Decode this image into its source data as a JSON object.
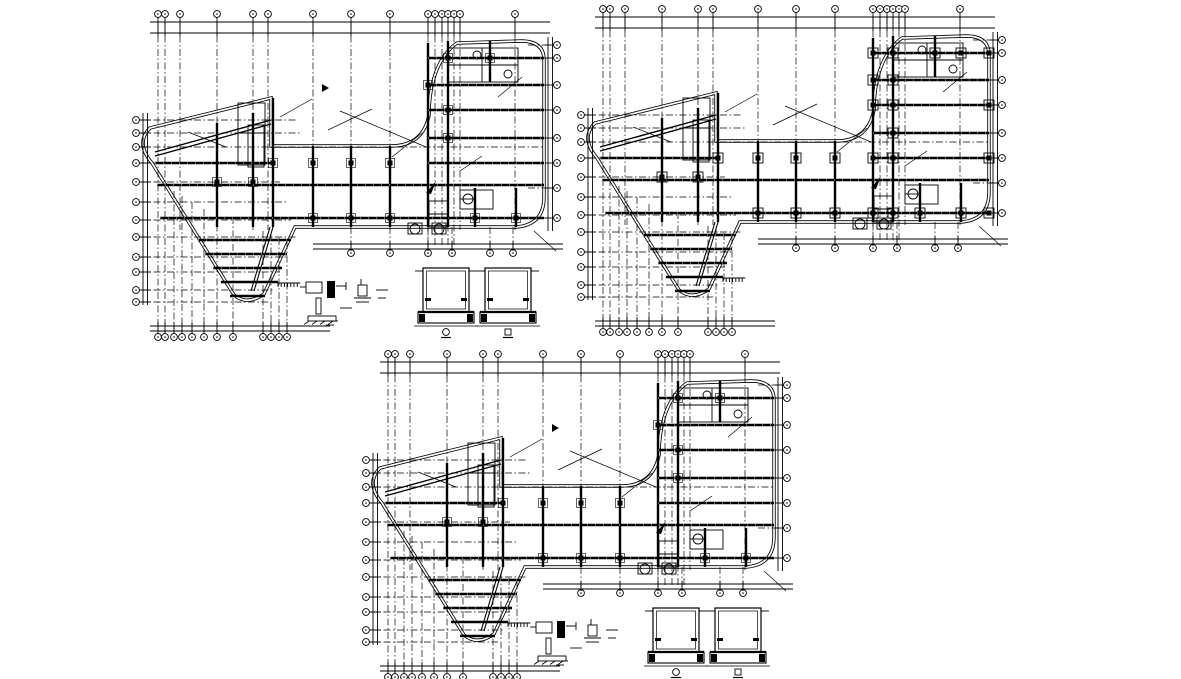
{
  "meta": {
    "document_type": "cad-structural-framing-plans",
    "canvas": {
      "width": 1181,
      "height": 679
    },
    "colors": {
      "background": "#ffffff",
      "line": "#000000"
    }
  },
  "drawing": {
    "plans": [
      {
        "id": "framing-plan-top-left",
        "origin": {
          "x": 130,
          "y": 5
        },
        "variant": "simple",
        "has_details": true,
        "has_cursor": true
      },
      {
        "id": "framing-plan-top-right",
        "origin": {
          "x": 575,
          "y": 0
        },
        "variant": "boxed",
        "has_details": false,
        "has_cursor": false
      },
      {
        "id": "framing-plan-bottom",
        "origin": {
          "x": 360,
          "y": 345
        },
        "variant": "simple",
        "has_details": true,
        "has_cursor": true
      }
    ],
    "template": {
      "outline": "M20,123 L141,93 L141,141 L261,141 Q293,141 299,110 C299,90 303,55 327,38 L391,36 Q414,36 414,55 L414,192 Q414,220 386,222 L165,222 L134,289 Q117,301 104,290 L22,158 Q5,138 20,123 Z",
      "wing_slope": [
        [
          25,
          147,
          141,
          115
        ],
        [
          25,
          151,
          141,
          119
        ]
      ],
      "beams_h": [
        [
          25,
          158,
          143
        ],
        [
          27,
          180,
          414
        ],
        [
          30,
          213,
          414
        ],
        [
          68,
          235,
          161
        ],
        [
          75,
          249,
          157
        ],
        [
          83,
          263,
          152
        ],
        [
          91,
          277,
          148
        ],
        [
          100,
          291,
          135
        ],
        [
          298,
          53,
          414
        ],
        [
          298,
          80,
          414
        ],
        [
          298,
          105,
          414
        ],
        [
          298,
          133,
          414
        ],
        [
          298,
          158,
          414
        ]
      ],
      "beams_v": [
        [
          87,
          118,
          222
        ],
        [
          123,
          108,
          222
        ],
        [
          143,
          93,
          222
        ],
        [
          183,
          141,
          222
        ],
        [
          221,
          141,
          222
        ],
        [
          260,
          141,
          222
        ],
        [
          298,
          38,
          222
        ],
        [
          318,
          36,
          222
        ],
        [
          360,
          36,
          77
        ],
        [
          345,
          183,
          222
        ],
        [
          386,
          183,
          222
        ]
      ],
      "beam_diag": [
        [
          140,
          222,
          121,
          286
        ]
      ],
      "thin_rects": [
        [
          108,
          98,
          27,
          62
        ],
        [
          318,
          43,
          70,
          34
        ],
        [
          330,
          185,
          33,
          19
        ],
        [
          299,
          196,
          19,
          26
        ],
        [
          118,
          120,
          16,
          42
        ],
        [
          278,
          218,
          14,
          11
        ],
        [
          302,
          218,
          14,
          11
        ]
      ],
      "thin_lines": [
        [
          318,
          60,
          388,
          60
        ],
        [
          352,
          43,
          352,
          77
        ],
        [
          299,
          209,
          318,
          209
        ],
        [
          108,
          128,
          135,
          128
        ],
        [
          330,
          194,
          346,
          194
        ]
      ],
      "small_circles": [
        [
          338,
          194,
          5
        ],
        [
          285,
          224,
          5
        ],
        [
          309,
          224,
          5
        ],
        [
          378,
          69,
          4
        ],
        [
          347,
          50,
          4
        ]
      ],
      "grid_v": [
        [
          28,
          17,
          326,
          1,
          1
        ],
        [
          35,
          17,
          326,
          1,
          1
        ],
        [
          50,
          17,
          225,
          1,
          0
        ],
        [
          44,
          186,
          326,
          0,
          1
        ],
        [
          52,
          191,
          326,
          0,
          1
        ],
        [
          62,
          197,
          326,
          0,
          1
        ],
        [
          74,
          204,
          326,
          0,
          1
        ],
        [
          87,
          17,
          326,
          1,
          1
        ],
        [
          103,
          212,
          326,
          0,
          1
        ],
        [
          123,
          17,
          225,
          1,
          0
        ],
        [
          138,
          17,
          225,
          1,
          0
        ],
        [
          133,
          226,
          326,
          0,
          1
        ],
        [
          141,
          229,
          326,
          0,
          1
        ],
        [
          149,
          233,
          326,
          0,
          1
        ],
        [
          157,
          237,
          326,
          0,
          1
        ],
        [
          183,
          17,
          222,
          1,
          0
        ],
        [
          221,
          17,
          222,
          1,
          0
        ],
        [
          260,
          17,
          222,
          1,
          0
        ],
        [
          298,
          17,
          240,
          1,
          0
        ],
        [
          305,
          17,
          240,
          1,
          0
        ],
        [
          312,
          17,
          240,
          1,
          0
        ],
        [
          318,
          17,
          240,
          1,
          0
        ],
        [
          324,
          17,
          240,
          1,
          0
        ],
        [
          330,
          17,
          225,
          1,
          0
        ],
        [
          385,
          17,
          225,
          1,
          0
        ]
      ],
      "grid_h": [
        [
          40,
          398,
          421,
          0,
          1
        ],
        [
          53,
          398,
          421,
          0,
          1
        ],
        [
          80,
          398,
          421,
          0,
          1
        ],
        [
          105,
          398,
          421,
          0,
          1
        ],
        [
          133,
          398,
          421,
          0,
          1
        ],
        [
          183,
          398,
          421,
          0,
          1
        ],
        [
          213,
          398,
          421,
          0,
          1
        ],
        [
          115,
          10,
          166,
          1,
          0
        ],
        [
          128,
          10,
          170,
          1,
          0
        ],
        [
          142,
          10,
          414,
          1,
          0
        ],
        [
          158,
          10,
          143,
          1,
          1
        ],
        [
          177,
          10,
          150,
          1,
          0
        ],
        [
          197,
          10,
          156,
          1,
          0
        ],
        [
          215,
          10,
          161,
          1,
          0
        ],
        [
          232,
          10,
          166,
          1,
          0
        ],
        [
          252,
          10,
          156,
          1,
          0
        ],
        [
          267,
          10,
          150,
          1,
          0
        ],
        [
          285,
          10,
          143,
          1,
          0
        ],
        [
          297,
          10,
          138,
          1,
          0
        ]
      ],
      "arm_stub_x": [
        221,
        260,
        298,
        322,
        360,
        383
      ],
      "dims": {
        "top": {
          "a": 17,
          "b": 28,
          "from": 20,
          "to": 420
        },
        "left": {
          "a": 13,
          "b": 17.5,
          "from": 108,
          "to": 300
        },
        "right": {
          "a": 418,
          "b": 422.5,
          "from": 32,
          "to": 226
        },
        "bottom_leg": {
          "a": 321,
          "b": 326,
          "from": 20,
          "to": 200
        },
        "bottom_arm": {
          "a": 239,
          "b": 244,
          "from": 183,
          "to": 433
        }
      },
      "bubble": {
        "r": 3.4,
        "top_y": 9,
        "bottom_y": 332,
        "left_x": 6,
        "right_x": 427,
        "arm_y": 248
      },
      "columns": [
        [
          183,
          158
        ],
        [
          221,
          158
        ],
        [
          260,
          158
        ],
        [
          143,
          158
        ],
        [
          87,
          177
        ],
        [
          123,
          177
        ],
        [
          183,
          213
        ],
        [
          221,
          213
        ],
        [
          260,
          213
        ],
        [
          318,
          53
        ],
        [
          318,
          105
        ],
        [
          318,
          133
        ],
        [
          345,
          213
        ],
        [
          386,
          213
        ],
        [
          298,
          80
        ],
        [
          360,
          53
        ]
      ],
      "columns_boxed_extra": [
        [
          298,
          53
        ],
        [
          298,
          105
        ],
        [
          298,
          158
        ],
        [
          298,
          213
        ],
        [
          414,
          53
        ],
        [
          414,
          105
        ],
        [
          414,
          158
        ],
        [
          414,
          213
        ],
        [
          318,
          158
        ],
        [
          318,
          213
        ],
        [
          318,
          80
        ],
        [
          386,
          53
        ]
      ],
      "leaders": [
        [
          198,
          125,
          242,
          104
        ],
        [
          210,
          106,
          296,
          142
        ],
        [
          262,
          152,
          292,
          128
        ],
        [
          150,
          112,
          182,
          94
        ],
        [
          330,
          166,
          352,
          151
        ],
        [
          96,
          142,
          58,
          127
        ],
        [
          368,
          92,
          392,
          72
        ],
        [
          404,
          226,
          426,
          246
        ]
      ],
      "hatch": {
        "x": 148,
        "y": 278,
        "n": 7,
        "dx": 3.2
      },
      "cursor": [
        192,
        83
      ],
      "flag": [
        [
          296,
          188
        ],
        [
          306,
          176
        ],
        [
          301,
          189
        ]
      ],
      "detail_small": {
        "rects": [
          [
            176,
            277,
            16,
            11,
            0
          ],
          [
            197,
            276,
            8,
            17,
            1
          ],
          [
            228,
            280,
            9,
            11,
            0
          ],
          [
            186,
            293,
            5,
            16,
            0
          ],
          [
            178,
            311,
            28,
            5,
            0
          ]
        ],
        "lines": [
          [
            170,
            282,
            176,
            282
          ],
          [
            206,
            281,
            216,
            281
          ],
          [
            216,
            277,
            216,
            285
          ],
          [
            224,
            293,
            241,
            293
          ],
          [
            226,
            297,
            239,
            297
          ],
          [
            192,
            316,
            208,
            316
          ],
          [
            196,
            320,
            204,
            320
          ],
          [
            210,
            303,
            222,
            303
          ],
          [
            231,
            274,
            231,
            280
          ],
          [
            246,
            285,
            258,
            285
          ],
          [
            248,
            293,
            256,
            293
          ]
        ]
      },
      "detail_section": {
        "offsets": [
          0,
          62
        ],
        "outer": [
          293,
          263,
          46,
          44
        ],
        "slab": [
          288,
          307,
          56,
          11
        ],
        "label_y": 327
      }
    }
  }
}
